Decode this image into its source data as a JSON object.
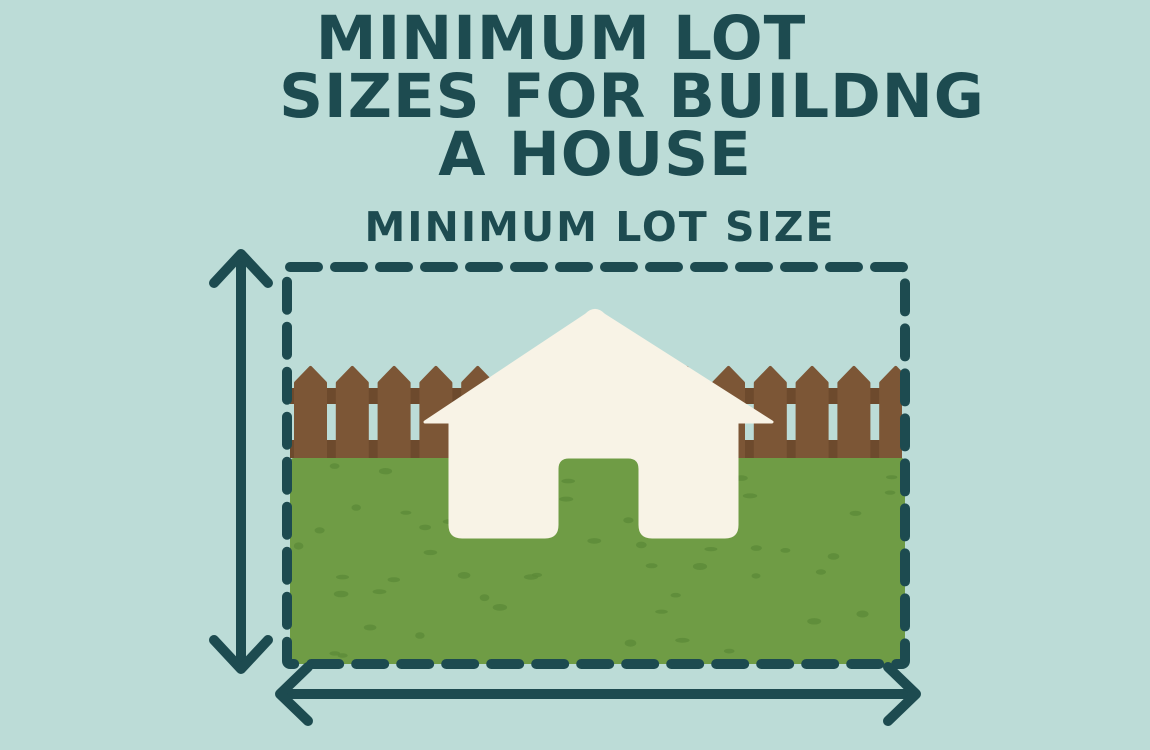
{
  "title": {
    "line1": "MINIMUM LOT",
    "line2": "SIZES FOR BUILDNG",
    "line3": "A HOUSE"
  },
  "diagram": {
    "label": "MINIMUM LOT SIZE",
    "parts": [
      "lot-boundary-dashed-rectangle",
      "vertical-dimension-arrow",
      "horizontal-dimension-arrow",
      "picket-fence",
      "grass-lot",
      "house"
    ]
  },
  "colors": {
    "background": "#bcdcd7",
    "ink": "#1d4b50",
    "grass": "#6f9c45",
    "grass_speckle": "#5c8b38",
    "fence": "#7c5636",
    "fence_rail": "#6d4a2d",
    "house": "#f8f3e6"
  }
}
